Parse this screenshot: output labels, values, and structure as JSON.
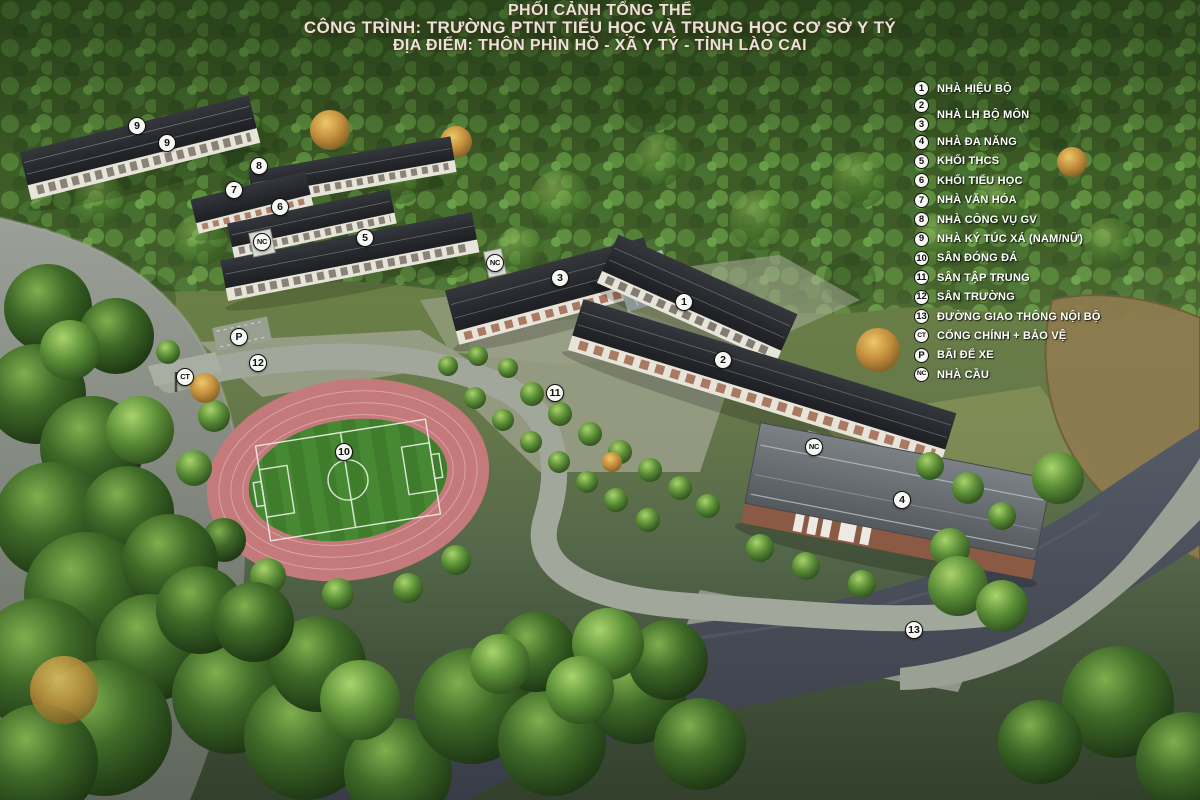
{
  "title": {
    "line1": "PHỐI CẢNH TỔNG THỂ",
    "line2": "CÔNG TRÌNH: TRƯỜNG PTNT TIỂU HỌC VÀ TRUNG HỌC CƠ SỞ Y TÝ",
    "line3": "ĐỊA ĐIỂM: THÔN PHÌN HỒ - XÃ Y TÝ - TỈNH LÀO CAI"
  },
  "legend": {
    "items": [
      {
        "markers": [
          "1"
        ],
        "label": "NHÀ HIỆU BỘ"
      },
      {
        "markers": [
          "2",
          "3"
        ],
        "label": "NHÀ LH BỘ MÔN"
      },
      {
        "markers": [
          "4"
        ],
        "label": "NHÀ ĐA NĂNG"
      },
      {
        "markers": [
          "5"
        ],
        "label": "KHỐI THCS"
      },
      {
        "markers": [
          "6"
        ],
        "label": "KHỐI TIỂU HỌC"
      },
      {
        "markers": [
          "7"
        ],
        "label": "NHÀ VĂN HÓA"
      },
      {
        "markers": [
          "8"
        ],
        "label": "NHÀ CÔNG VỤ GV"
      },
      {
        "markers": [
          "9"
        ],
        "label": "NHÀ KÝ TÚC XÁ (NAM/NỮ)"
      },
      {
        "markers": [
          "10"
        ],
        "label": "SÂN ĐÓNG ĐÁ"
      },
      {
        "markers": [
          "11"
        ],
        "label": "SÂN TẬP TRUNG"
      },
      {
        "markers": [
          "12"
        ],
        "label": "SÂN TRƯỜNG"
      },
      {
        "markers": [
          "13"
        ],
        "label": "ĐƯỜNG GIAO THÔNG NỘI BỘ"
      },
      {
        "markers": [
          "CT"
        ],
        "label": "CỔNG CHÍNH + BẢO VỆ"
      },
      {
        "markers": [
          "P"
        ],
        "label": "BÃI ĐỂ XE"
      },
      {
        "markers": [
          "NC"
        ],
        "label": "NHÀ CẦU"
      }
    ]
  },
  "map_markers": [
    {
      "label": "9",
      "x": 137,
      "y": 126
    },
    {
      "label": "9",
      "x": 167,
      "y": 143
    },
    {
      "label": "8",
      "x": 259,
      "y": 166
    },
    {
      "label": "7",
      "x": 234,
      "y": 190
    },
    {
      "label": "6",
      "x": 280,
      "y": 207
    },
    {
      "label": "NC",
      "x": 262,
      "y": 242
    },
    {
      "label": "5",
      "x": 365,
      "y": 238
    },
    {
      "label": "NC",
      "x": 495,
      "y": 263
    },
    {
      "label": "3",
      "x": 560,
      "y": 278
    },
    {
      "label": "1",
      "x": 684,
      "y": 302
    },
    {
      "label": "2",
      "x": 723,
      "y": 360
    },
    {
      "label": "P",
      "x": 239,
      "y": 337
    },
    {
      "label": "12",
      "x": 258,
      "y": 363
    },
    {
      "label": "CT",
      "x": 185,
      "y": 377
    },
    {
      "label": "11",
      "x": 555,
      "y": 393
    },
    {
      "label": "10",
      "x": 344,
      "y": 452
    },
    {
      "label": "NC",
      "x": 814,
      "y": 447
    },
    {
      "label": "4",
      "x": 902,
      "y": 500
    },
    {
      "label": "13",
      "x": 914,
      "y": 630
    }
  ],
  "colors": {
    "marker_bg": "#f7f7f3",
    "marker_border": "#111111",
    "legend_text": "#ffffff",
    "title_text": "#e8e3d8",
    "track": "#c4797b",
    "field": "#3f7d2c",
    "roof_dark": "#27292d",
    "roof_gray": "#6a7074",
    "water": "#848a83",
    "road_dark": "#434854",
    "pond": "#8d7b4f"
  }
}
